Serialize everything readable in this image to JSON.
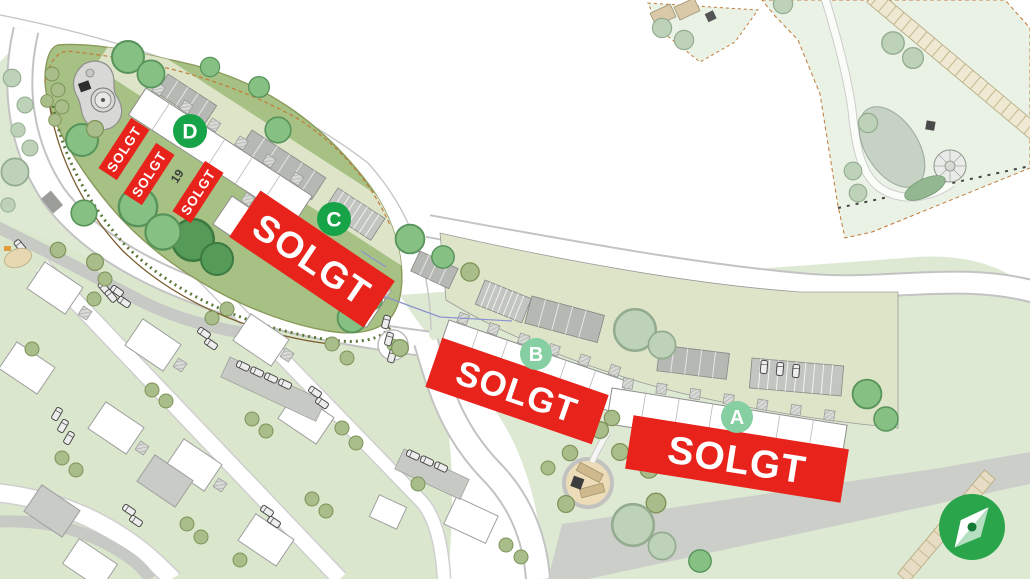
{
  "plan": {
    "buildings": [
      {
        "letter": "A",
        "status": "SOLGT",
        "badge_style": "light"
      },
      {
        "letter": "B",
        "status": "SOLGT",
        "badge_style": "light"
      },
      {
        "letter": "C",
        "status": "SOLGT",
        "badge_style": "dark"
      },
      {
        "letter": "D",
        "status": "SOLGT",
        "badge_style": "dark"
      }
    ],
    "building_d_unit_banners": [
      "SOLGT",
      "SOLGT",
      "SOLGT"
    ],
    "available_unit_label": "19",
    "colors": {
      "sold_red": "#e8231b",
      "badge_dark_green": "#17a347",
      "badge_light_green": "#85cfa2",
      "compass_green": "#2aa54b"
    }
  }
}
